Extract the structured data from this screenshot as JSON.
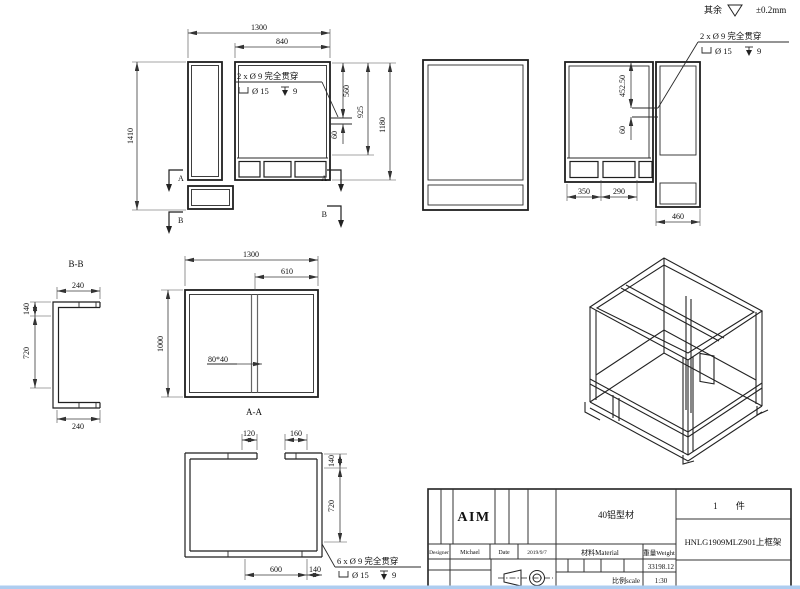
{
  "sheet": {
    "surface_prefix": "其余",
    "surface_tolerance": "±0.2mm",
    "line_color": "#1f1f1f",
    "accent_blue": "#2323c8"
  },
  "front_view": {
    "dim_width": "1300",
    "dim_inner_width": "840",
    "dim_height": "1410",
    "dim_560": "560",
    "dim_60": "60",
    "dim_925": "925",
    "dim_1180": "1180",
    "hole_note_line1": "2 x Ø 9 完全贯穿",
    "hole_note_dia": "Ø 15",
    "hole_note_depth": "9",
    "section_label_a": "A",
    "section_label_b": "B"
  },
  "right_view": {
    "dim_452": "452.50",
    "dim_60": "60",
    "dim_350": "350",
    "dim_290": "290",
    "dim_460": "460",
    "hole_note_line1": "2 x Ø 9 完全贯穿",
    "hole_note_dia": "Ø 15",
    "hole_note_depth": "9"
  },
  "section_bb": {
    "label": "B-B",
    "dim_top": "240",
    "dim_140": "140",
    "dim_720": "720",
    "dim_bottom": "240"
  },
  "plan_view": {
    "dim_width": "1300",
    "dim_610": "610",
    "dim_height": "1000",
    "profile_note": "80*40",
    "section_label": "A-A"
  },
  "section_aa": {
    "dim_120": "120",
    "dim_160": "160",
    "dim_140_right": "140",
    "dim_720": "720",
    "dim_600": "600",
    "dim_140_bottom": "140",
    "hole_note_line1": "6 x Ø 9 完全贯穿",
    "hole_note_dia": "Ø 15",
    "hole_note_depth": "9"
  },
  "title_block": {
    "logo": "AIM",
    "material_spec": "40铝型材",
    "designer_label": "Designer",
    "designer_value": "Michael",
    "date_label": "Date",
    "date_value": "2019/9/7",
    "material_label": "材料Material",
    "weight_label": "重量Weight",
    "weight_value": "33198.12",
    "scale_label": "比例scale",
    "scale_value": "1:30",
    "quantity": "1 件",
    "drawing_title": "HNLG1909MLZ901上框架"
  }
}
